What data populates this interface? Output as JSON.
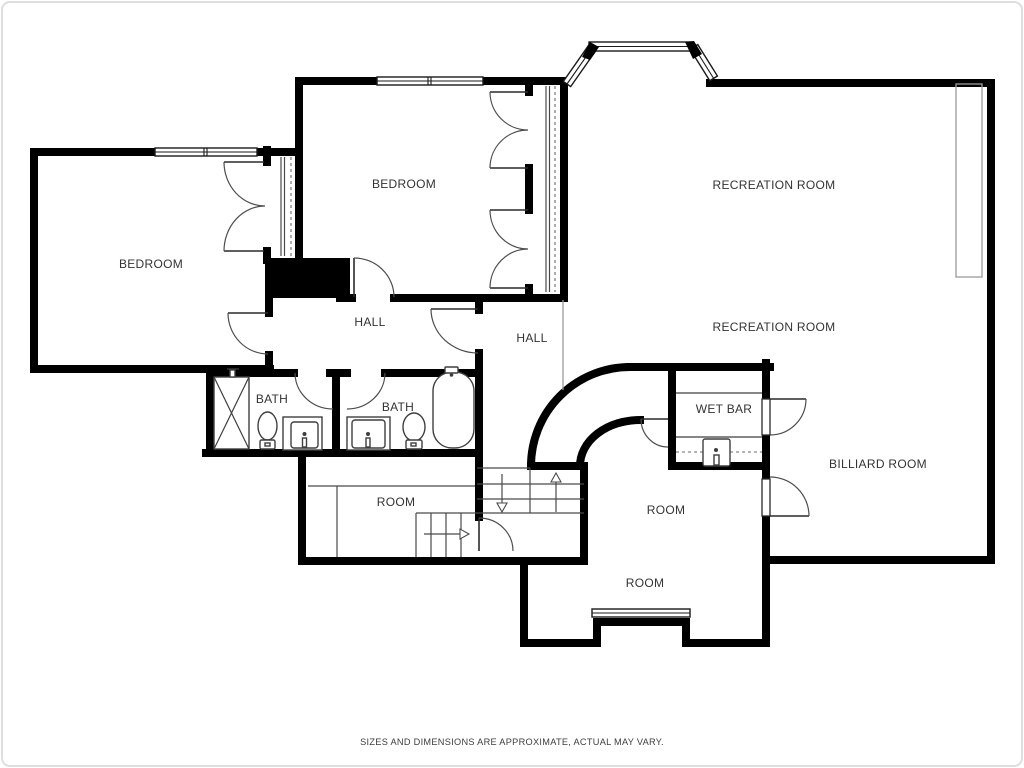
{
  "page": {
    "background": "#ffffff",
    "border_color": "#dedede"
  },
  "palette": {
    "wall": "#000000",
    "detail_line": "#3f3f3f",
    "light_line": "#9c9c9c",
    "label_text": "#333333",
    "disclaimer_text": "#3d3d3d"
  },
  "floor_plan": {
    "rooms": [
      {
        "id": "bedroom-west",
        "label": "BEDROOM"
      },
      {
        "id": "bedroom-north",
        "label": "BEDROOM"
      },
      {
        "id": "recreation-room-upper",
        "label": "RECREATION ROOM"
      },
      {
        "id": "recreation-room-lower",
        "label": "RECREATION ROOM"
      },
      {
        "id": "hall-west",
        "label": "HALL"
      },
      {
        "id": "hall-east",
        "label": "HALL"
      },
      {
        "id": "bath-west",
        "label": "BATH"
      },
      {
        "id": "bath-east",
        "label": "BATH"
      },
      {
        "id": "wet-bar",
        "label": "WET BAR"
      },
      {
        "id": "billiard-room",
        "label": "BILLIARD ROOM"
      },
      {
        "id": "room-center",
        "label": "ROOM"
      },
      {
        "id": "room-south",
        "label": "ROOM"
      },
      {
        "id": "room-west",
        "label": "ROOM"
      }
    ],
    "disclaimer": "SIZES AND DIMENSIONS ARE APPROXIMATE, ACTUAL MAY VARY."
  }
}
